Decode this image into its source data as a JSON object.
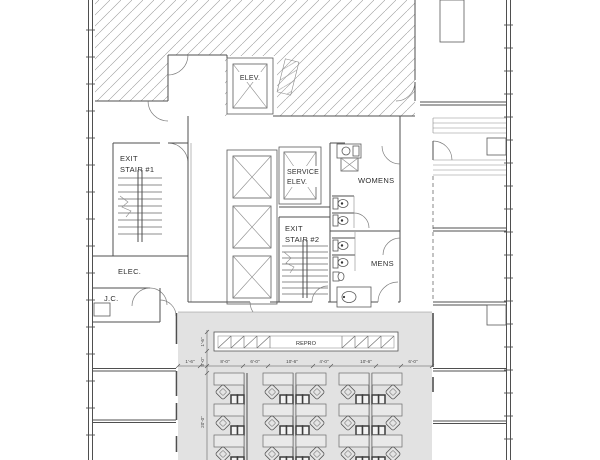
{
  "drawing": {
    "title": "core-and-shell-floor-plan",
    "rooms": {
      "elevator": "ELEV.",
      "exit_stair_1_line1": "EXIT",
      "exit_stair_1_line2": "STAIR #1",
      "service_elev_line1": "SERVICE",
      "service_elev_line2": "ELEV.",
      "womens": "WOMENS",
      "exit_stair_2_line1": "EXIT",
      "exit_stair_2_line2": "STAIR #2",
      "mens": "MENS",
      "elec": "ELEC.",
      "jc": "J.C.",
      "repro": "REPRO"
    },
    "dimensions": {
      "h": [
        "1'-6\"",
        "8'-0\"",
        "6'-0\"",
        "10'-6\"",
        "4'-0\"",
        "10'-6\"",
        "6'-0\""
      ],
      "v": [
        "1'-6\"",
        "5'-0\"",
        "20'-0\""
      ]
    },
    "colors": {
      "wall": "#4f4f4f",
      "hatch": "#8f8f8f",
      "open_office_fill": "#e2e2e2",
      "text": "#2e2e2e"
    }
  }
}
